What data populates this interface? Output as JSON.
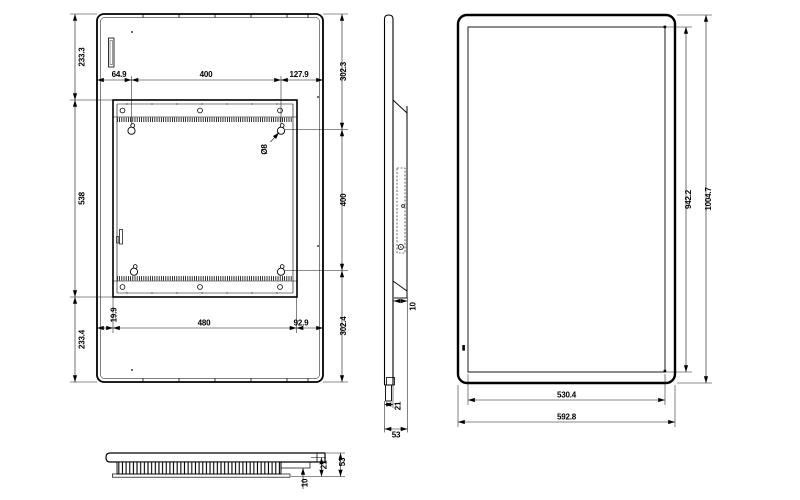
{
  "back_view": {
    "dim_left_top": "233.3",
    "dim_left_middle": "538",
    "dim_left_bottom": "233.4",
    "dim_right_top": "302.3",
    "dim_right_middle": "400",
    "dim_right_bottom": "302.4",
    "dim_top_left": "64.9",
    "dim_top_middle": "400",
    "dim_top_right": "127.9",
    "dim_bottom_left": "19.9",
    "dim_bottom_middle": "480",
    "dim_bottom_right": "92.9",
    "hole_callout": "Ø8"
  },
  "side_view": {
    "dim_bracket_offset": "10",
    "dim_body_thickness": "21",
    "dim_total_depth": "53"
  },
  "front_view": {
    "dim_inner_height": "942.2",
    "dim_outer_height": "1004.7",
    "dim_inner_width": "530.4",
    "dim_outer_width": "592.8"
  },
  "bottom_view": {
    "dim_total_depth": "53",
    "dim_step": "21",
    "dim_lip_offset": "10"
  }
}
